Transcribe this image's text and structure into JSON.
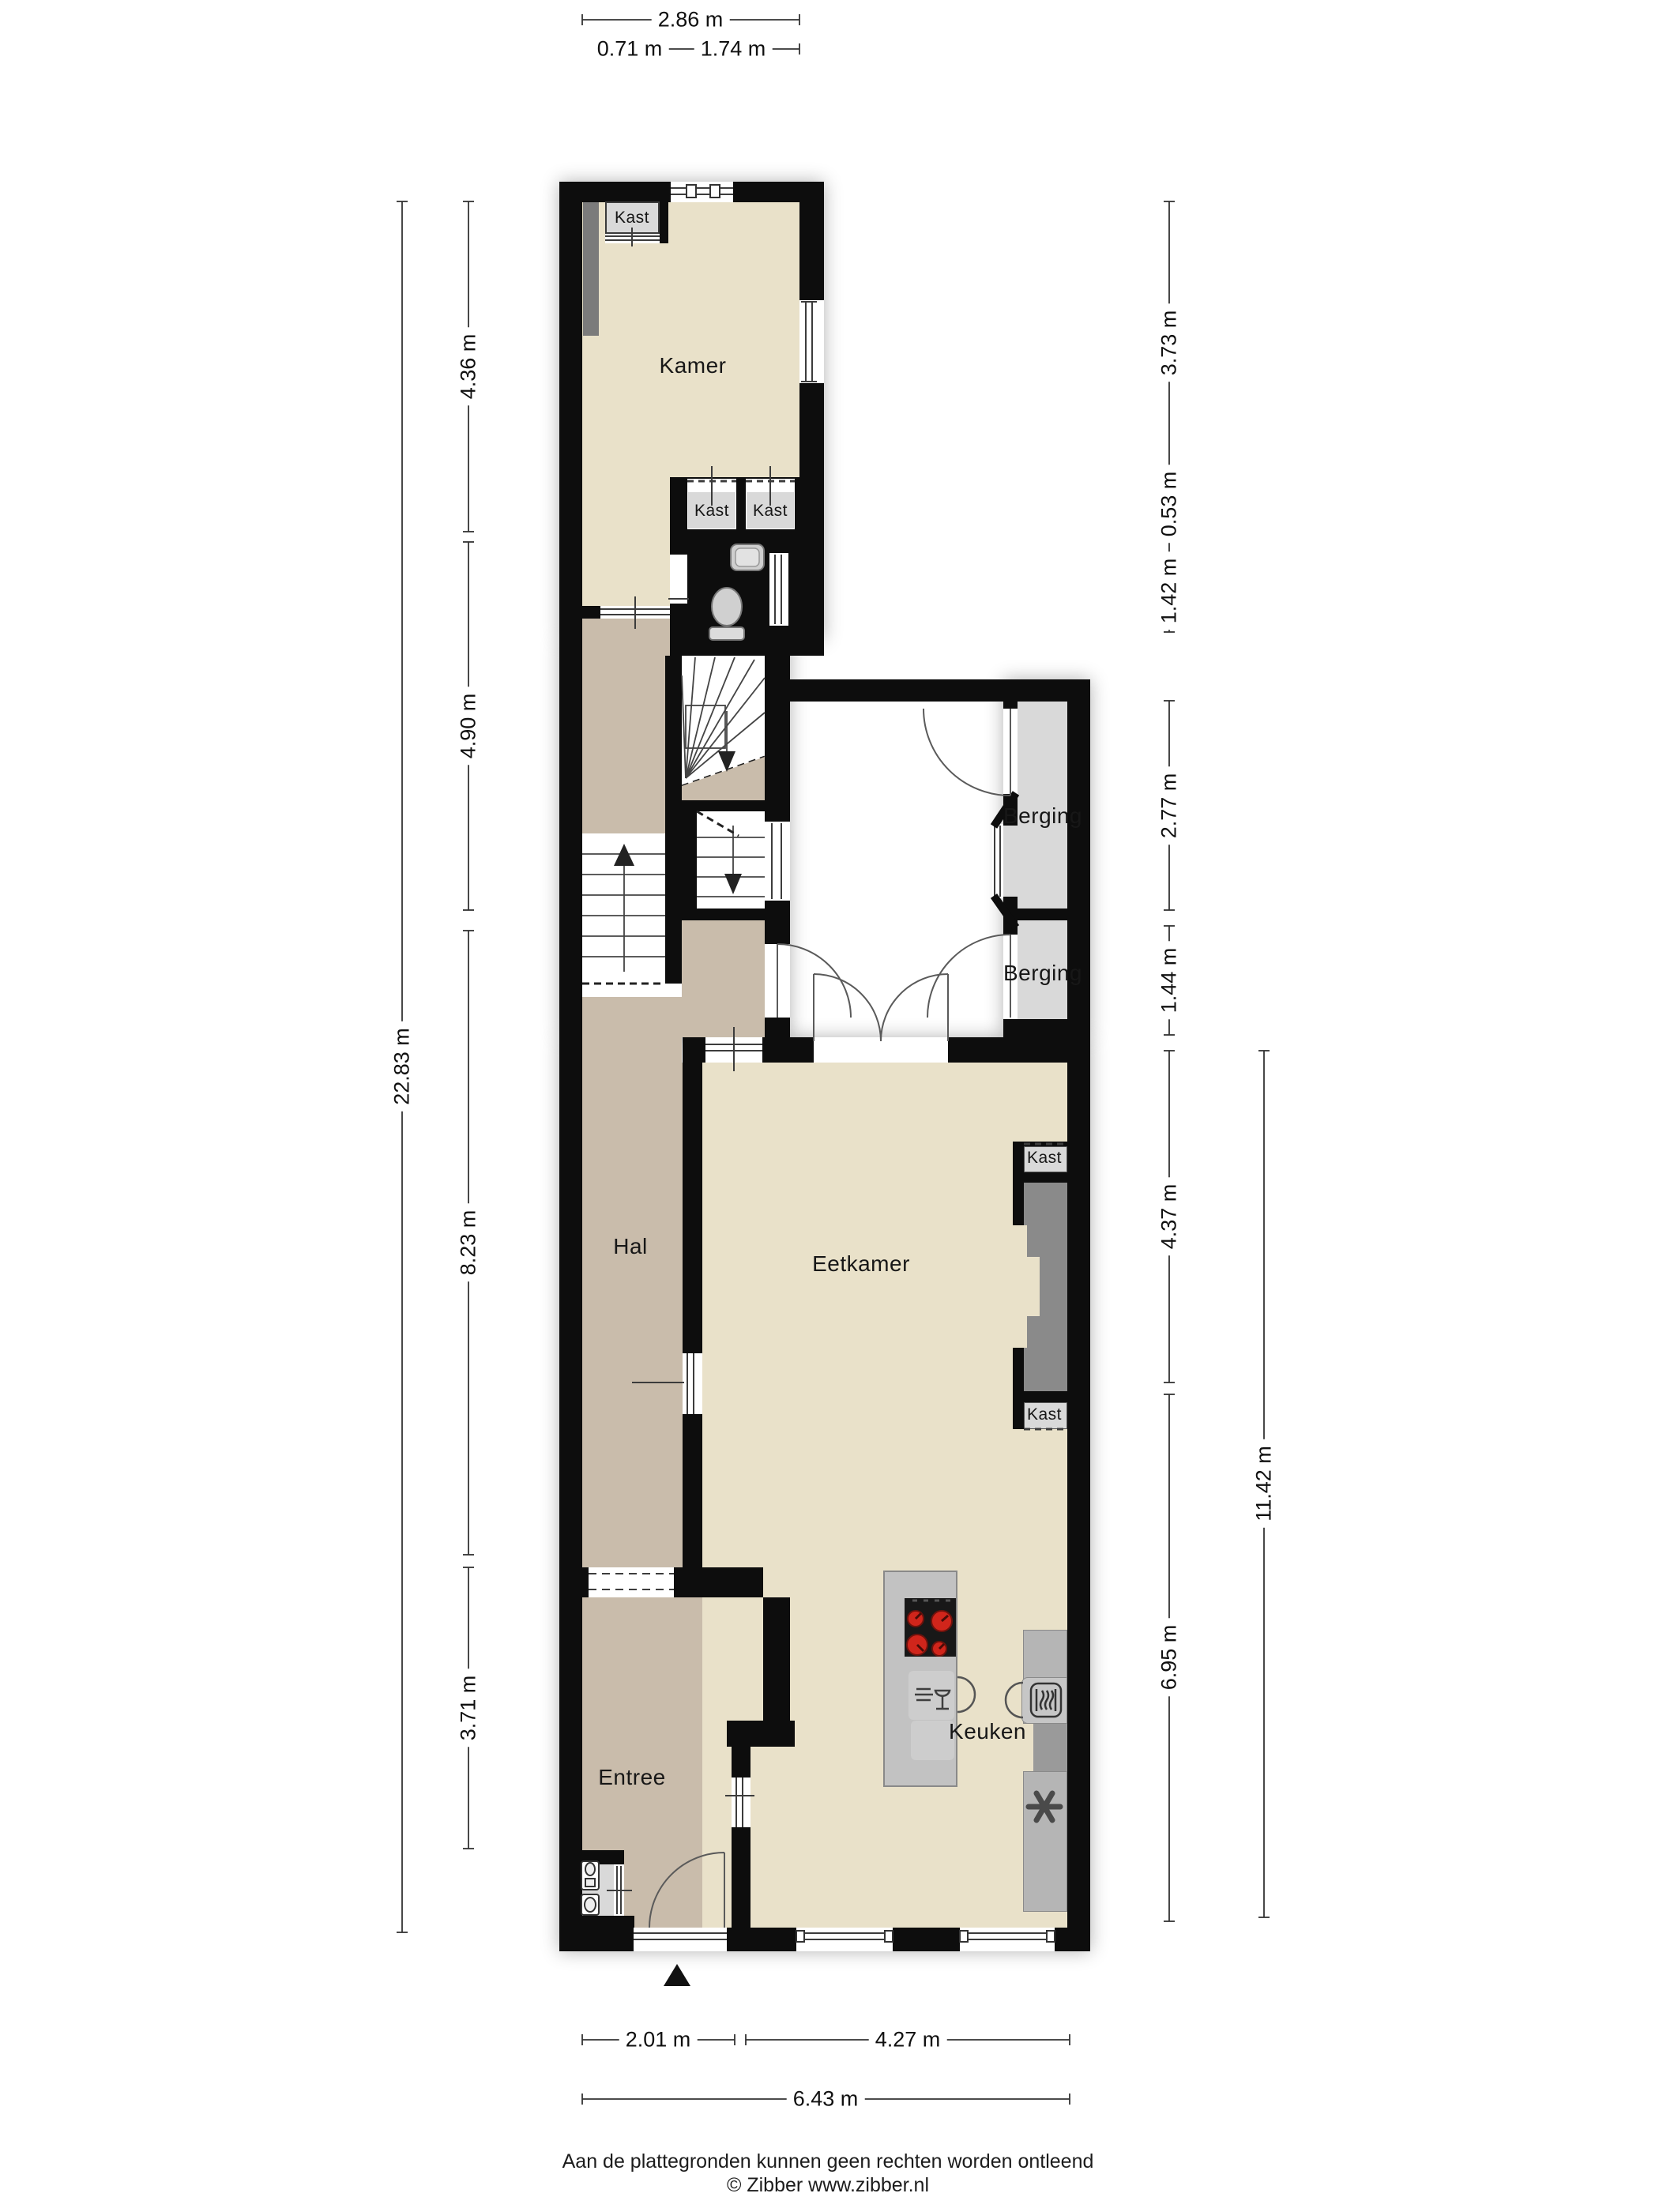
{
  "plan": {
    "rooms": {
      "kamer": "Kamer",
      "hal": "Hal",
      "eetkamer": "Eetkamer",
      "keuken": "Keuken",
      "entree": "Entree",
      "berging": "Berging",
      "kast": "Kast"
    },
    "dimensions": {
      "top": {
        "total": "2.86 m",
        "left": "0.71 m",
        "right": "1.74 m"
      },
      "left": {
        "segments": [
          "4.36 m",
          "4.90 m",
          "8.23 m",
          "3.71 m"
        ],
        "total": "22.83 m"
      },
      "right": {
        "segments": [
          "3.73 m",
          "0.53 m",
          "1.42 m",
          "2.77 m",
          "1.44 m",
          "4.37 m",
          "6.95 m"
        ],
        "total": "11.42 m"
      },
      "bottom": {
        "left": "2.01 m",
        "right": "4.27 m",
        "total": "6.43 m"
      }
    },
    "footer": {
      "disclaimer": "Aan de plattegronden kunnen geen rechten worden ontleend",
      "copyright": "© Zibber www.zibber.nl"
    },
    "icons": {
      "entrance_marker": "north-triangle",
      "hob": "4-burner-hob",
      "dishwasher": "glass-and-plates",
      "oven": "oven-waves",
      "extractor": "fan-star",
      "toilet": "toilet-bowl",
      "sink": "wash-basin"
    },
    "colors": {
      "wall": "#0d0d0d",
      "living_floor": "#e9e1c9",
      "hall_floor": "#c9bcab",
      "toilet_floor": "#a9bcd6",
      "storage_floor": "#d9d9d9",
      "counter_gray": "#bdbdbd",
      "burner_red": "#d0251b"
    }
  }
}
